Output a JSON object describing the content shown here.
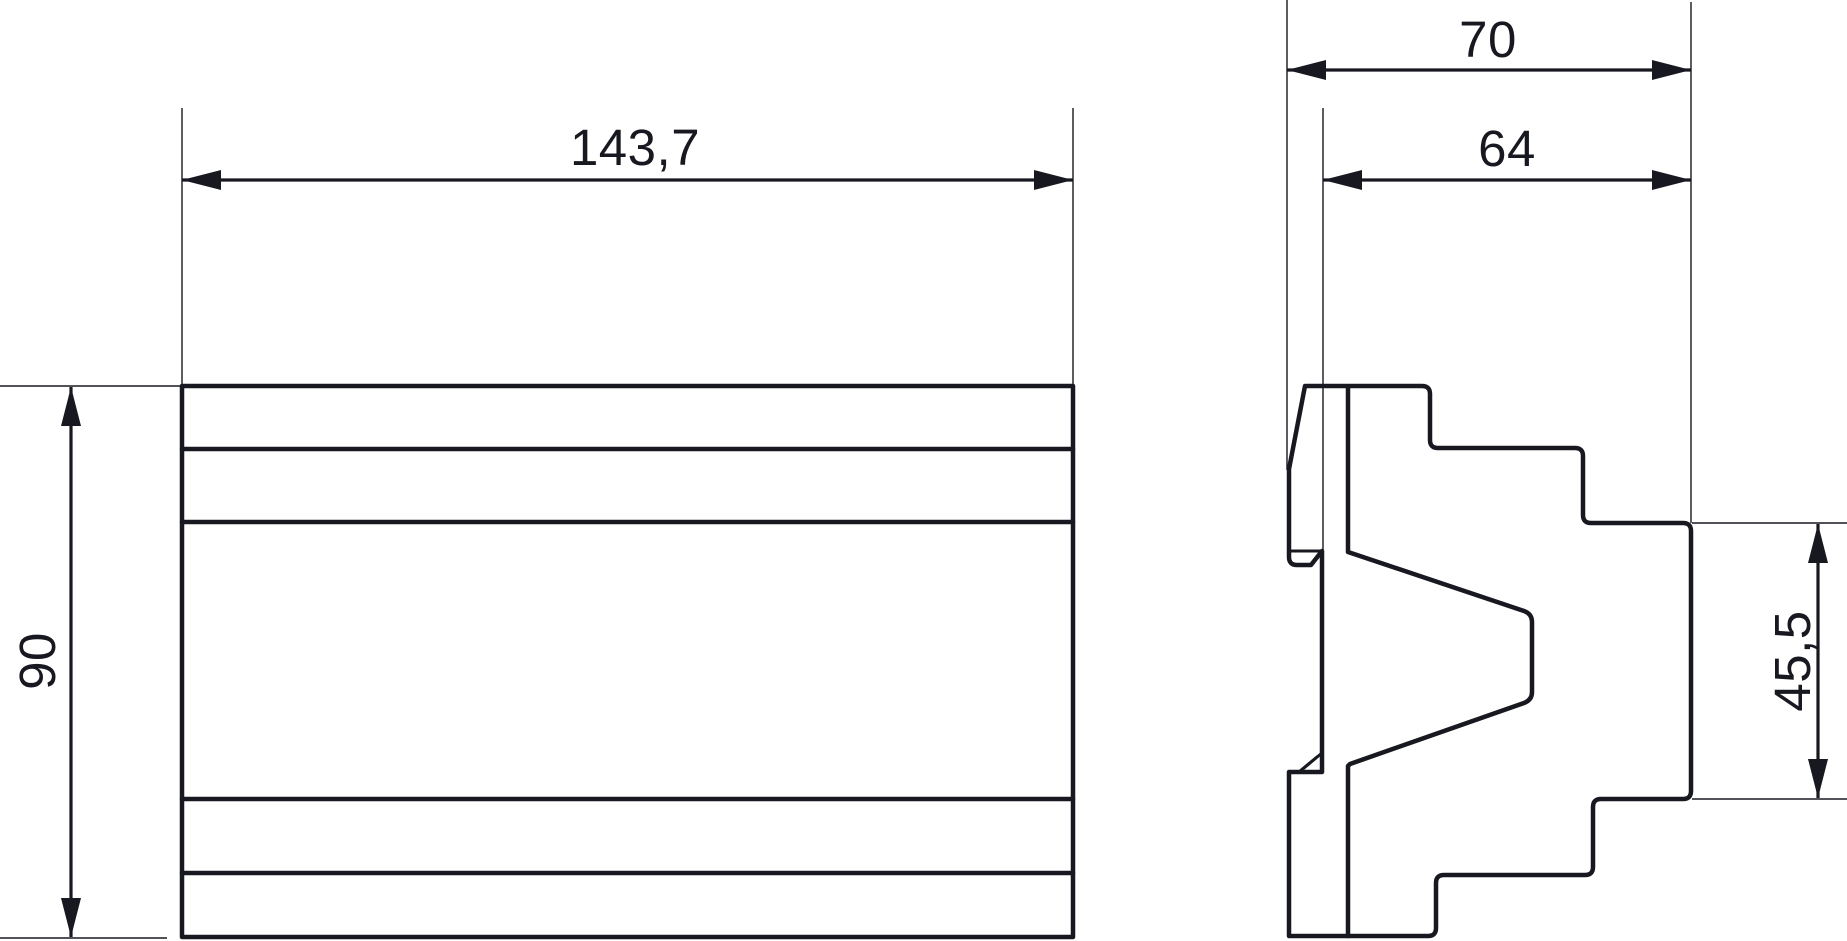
{
  "drawing": {
    "labels": {
      "width": "143,7",
      "height": "90",
      "depth_total": "70",
      "depth_body": "64",
      "front_section_height": "45,5"
    },
    "line_color": "#181820",
    "background_color": "#ffffff"
  }
}
